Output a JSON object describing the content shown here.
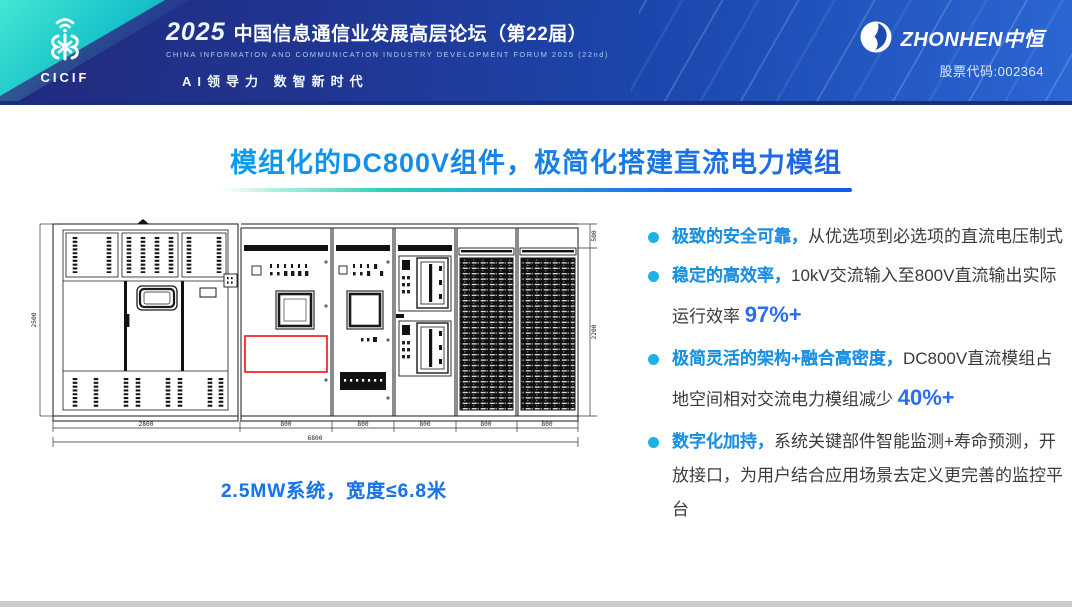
{
  "header": {
    "cicif_acronym": "CICIF",
    "year": "2025",
    "forum_title": "中国信息通信业发展高层论坛（第22届）",
    "forum_subtitle": "CHINA INFORMATION AND COMMUNICATION INDUSTRY DEVELOPMENT FORUM 2025 (22nd)",
    "tagline": "AI领导力 数智新时代",
    "company_en": "ZHONHEN",
    "company_cn": "中恒",
    "stock": "股票代码:002364"
  },
  "title": "模组化的DC800V组件，极简化搭建直流电力模组",
  "bullets": [
    {
      "lead": "极致的安全可靠，",
      "text": "从优选项到必选项的直流电压制式",
      "metric": ""
    },
    {
      "lead": "稳定的高效率，",
      "text": "10kV交流输入至800V直流输出实际运行效率 ",
      "metric": "97%+"
    },
    {
      "lead": "极简灵活的架构+融合高密度，",
      "text": "DC800V直流模组占地空间相对交流电力模组减少 ",
      "metric": "40%+"
    },
    {
      "lead": "数字化加持，",
      "text": "系统关键部件智能监测+寿命预测，开放接口，为用户结合应用场景去定义更完善的监控平台",
      "metric": ""
    }
  ],
  "diagram": {
    "caption": "2.5MW系统，宽度≤6.8米",
    "dims": {
      "left_height": "2500",
      "main_width": "2800",
      "unit_width": "800",
      "total_width": "6800",
      "top_right": "500",
      "right_height": "2200"
    }
  },
  "colors": {
    "accent_cyan": "#1FB0E8",
    "accent_blue": "#1E66F0",
    "highlight_red": "#F20000",
    "header_blue": "#1D49B4",
    "teal": "#18C9C9"
  }
}
